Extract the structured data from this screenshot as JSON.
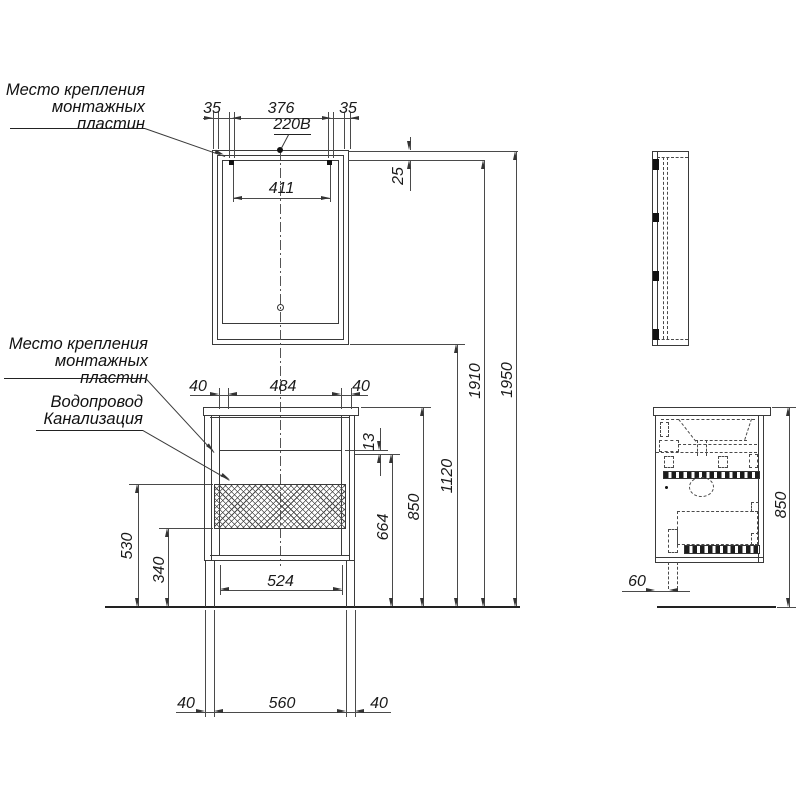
{
  "labels": {
    "mount_top": {
      "l1": "Место крепления",
      "l2": "монтажных",
      "l3": "пластин"
    },
    "mount_bottom": {
      "l1": "Место крепления",
      "l2": "монтажных",
      "l3": "пластин"
    },
    "plumbing": {
      "l1": "Водопровод",
      "l2": "Канализация"
    },
    "power": "220В"
  },
  "dims": {
    "m35l": "35",
    "m376": "376",
    "m35r": "35",
    "m411": "411",
    "m25": "25",
    "v40l": "40",
    "v484": "484",
    "v40r": "40",
    "v13": "13",
    "h664": "664",
    "h850": "850",
    "h1120": "1120",
    "h1910": "1910",
    "h1950": "1950",
    "h530": "530",
    "h340": "340",
    "w524": "524",
    "b40l": "40",
    "b560": "560",
    "b40r": "40",
    "s60": "60",
    "s850": "850"
  },
  "colors": {
    "line": "#3a3a3a",
    "background": "#ffffff"
  }
}
